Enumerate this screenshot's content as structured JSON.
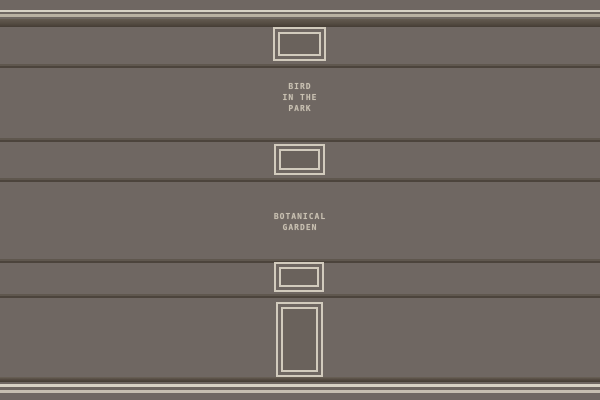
{
  "scene": {
    "name": "gallery-wall",
    "colors": {
      "wall": "#6f6762",
      "wall_recess": "#6a625c",
      "trim_light": "#d8d2c5",
      "trim_light_dim": "#b9b1a2",
      "trim_light_mid": "#c6beb0",
      "trim_dark": "#453d35",
      "frame_border": "#d2cbbd",
      "caption_text": "#c9c1b2"
    },
    "captions": [
      {
        "name": "bird-in-the-park",
        "lines": [
          "BIRD",
          "IN THE",
          "PARK"
        ]
      },
      {
        "name": "botanical-garden",
        "lines": [
          "BOTANICAL",
          "GARDEN"
        ]
      }
    ],
    "frames": [
      {
        "name": "empty-picture-frame-top",
        "shape": "landscape"
      },
      {
        "name": "empty-picture-frame-middle",
        "shape": "landscape"
      },
      {
        "name": "empty-picture-frame-lower",
        "shape": "landscape"
      },
      {
        "name": "empty-picture-frame-tall",
        "shape": "portrait"
      }
    ]
  }
}
